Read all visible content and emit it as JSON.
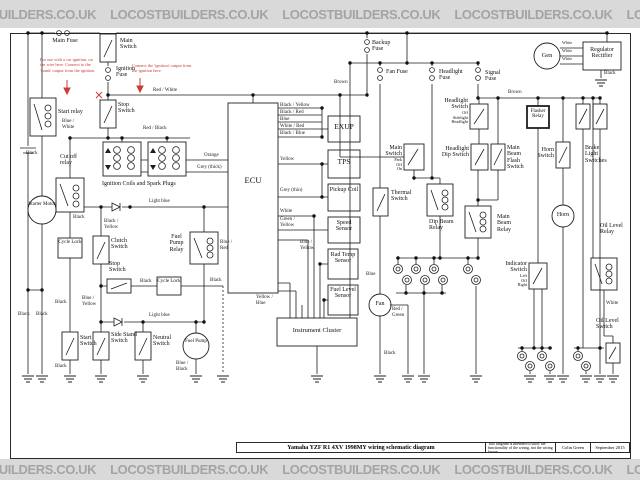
{
  "watermark": {
    "text": "LOCOSTBUILDERS.CO.UK"
  },
  "title_block": {
    "title": "Yamaha YZF R1 4XV 1998MY wiring schematic diagram",
    "note": "This diagram is intended to show the functionality of the wiring, not the wiring layout",
    "author": "Colin Green",
    "date": "September 2015"
  },
  "notes": {
    "crank": "For use with a car ignition, on the wire here. Connect to the 'crank' output from the ignition",
    "ignition": "Connect the 'ignition' output from the ignition here"
  },
  "components": {
    "main_fuse": "Main Fuse",
    "main_switch_top": "Main Switch",
    "ignition_fuse": "Ignition Fuse",
    "start_relay": "Start relay",
    "stop_switch_top": "Stop Switch",
    "cut_off_relay": "Cut off relay",
    "starter_motor": "Starter Motor",
    "ignition_coils": "Ignition Coils and Spark Plugs",
    "cycle_lock": "Cycle Lock",
    "clutch_switch": "Clutch Switch",
    "stop_switch_lower": "Stop Switch",
    "fuel_pump_relay": "Fuel Pump Relay",
    "start_switch": "Start Switch",
    "side_stand_switch": "Side Stand Switch",
    "neutral_switch": "Neutral Switch",
    "fuel_pump": "Fuel Pump",
    "ecu": "ECU",
    "exup": "EXUP",
    "tps": "TPS",
    "pickup_coil": "Pickup Coil",
    "speed_sensor": "Speed Sensor",
    "rad_temp_sensor": "Rad Temp Sensor",
    "fuel_level_sensor": "Fuel Level Sensor",
    "instrument_cluster": "Instrument Cluster",
    "backup_fuse": "Backup Fuse",
    "fan_fuse": "Fan Fuse",
    "headlight_fuse": "Headlight Fuse",
    "signal_fuse": "Signal Fuse",
    "gen": "Gen",
    "regulator_rectifier": "Regulator Rectifier",
    "main_switch_mid": "Main Switch",
    "main_switch_positions": "Park\nOff\nOn",
    "thermal_switch": "Thermal Switch",
    "dip_beam_relay": "Dip Beam Relay",
    "main_beam_relay": "Main Beam Relay",
    "headlight_switch": "Headlight Switch",
    "headlight_switch_positions": "Off\nSidelight\nHeadlight",
    "headlight_dip_switch": "Headlight Dip Switch",
    "main_beam_flash_switch": "Main Beam Flash Switch",
    "flasher_relay": "Flasher Relay",
    "horn_switch": "Horn Switch",
    "brake_light_switches": "Brake Light Switches",
    "horn": "Horn",
    "indicator_switch": "Indicator Switch",
    "indicator_switch_positions": "Left\nOff\nRight",
    "oil_level_relay": "Oil Level Relay",
    "oil_level_switch": "Oil Level Switch",
    "fan": "Fan"
  },
  "wire_labels": {
    "red_white": "Red / White",
    "red_black": "Red / Black",
    "blue_white": "Blue / White",
    "black": "Black",
    "black_yellow": "Black / Yellow",
    "black_red": "Black / Red",
    "black_blue": "Black / Blue",
    "white_red": "White / Red",
    "orange": "Orange",
    "grey_thick": "Grey (thick)",
    "grey_thin": "Grey (thin)",
    "light_blue": "Light blue",
    "blue": "Blue",
    "blue_red": "Blue / Red",
    "blue_yellow": "Blue / Yellow",
    "blue_black": "Blue / Black",
    "yellow": "Yellow",
    "yellow_blue": "Yellow / Blue",
    "green_yellow": "Green / Yellow",
    "white": "White",
    "brown": "Brown",
    "red_green": "Red / Green"
  }
}
